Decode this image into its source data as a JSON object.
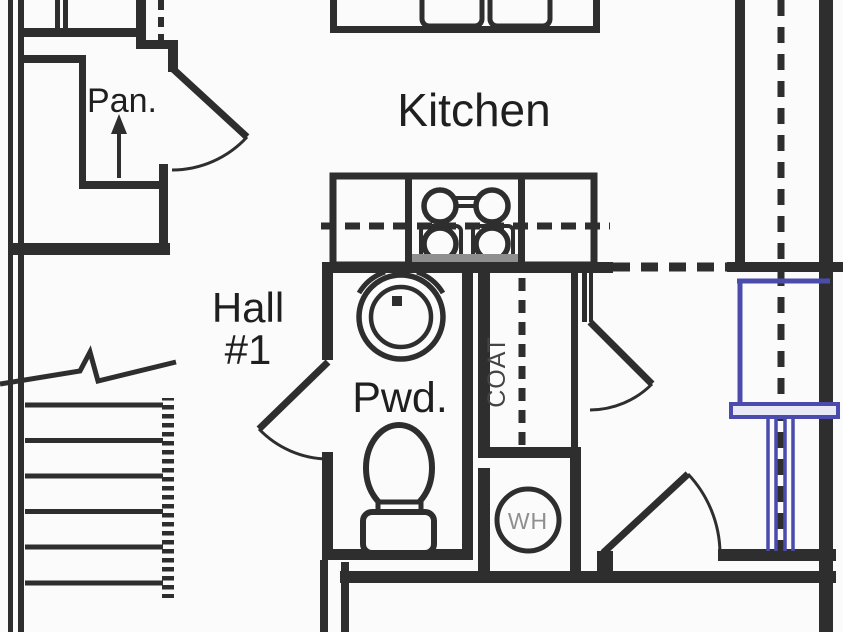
{
  "labels": {
    "pantry": "Pan.",
    "kitchen": "Kitchen",
    "hall_line1": "Hall",
    "hall_line2": "#1",
    "powder_room": "Pwd.",
    "coat_closet": "COAT",
    "water_heater": "WH"
  },
  "colors": {
    "wall": "#2e2e2e",
    "ink": "#1f1f1f",
    "muted": "#8f8f8f",
    "accent_blue": "#4b4bae",
    "blue_fill": "#e9e9f6",
    "paper": "#fbfbfb",
    "stove_front": "#8f8f8f",
    "coat_text": "#444444"
  }
}
